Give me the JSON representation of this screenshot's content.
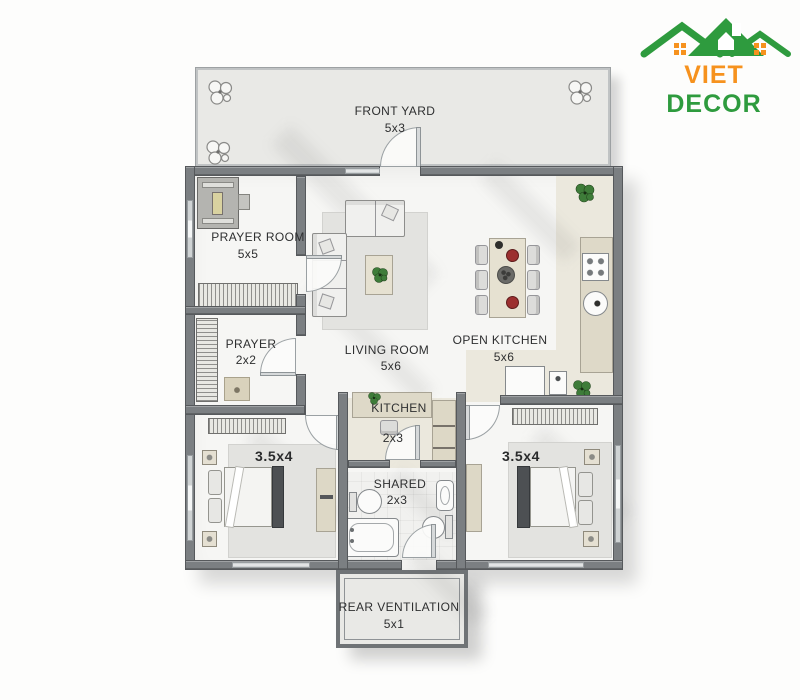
{
  "brand": {
    "word1": "VIET",
    "word2": "DECOR",
    "word1_color": "#F6921E",
    "word2_color": "#2E9B3E"
  },
  "rooms": {
    "front_yard": {
      "label": "FRONT YARD",
      "size": "5x3"
    },
    "prayer_room": {
      "label": "PRAYER ROOM",
      "size": "5x5"
    },
    "prayer": {
      "label": "PRAYER",
      "size": "2x2"
    },
    "living_room": {
      "label": "LIVING ROOM",
      "size": "5x6"
    },
    "open_kitchen": {
      "label": "OPEN KITCHEN",
      "size": "5x6"
    },
    "kitchen": {
      "label": "KITCHEN",
      "size": "2x3"
    },
    "bedroom_left": {
      "size": "3.5x4"
    },
    "shared": {
      "label": "SHARED",
      "size": "2x3"
    },
    "bedroom_right": {
      "size": "3.5x4"
    },
    "rear_ventilation": {
      "label": "REAR VENTILATION",
      "size": "5x1"
    }
  },
  "colors": {
    "wall": "#7B7F82",
    "floor": "#F6F6F4",
    "yard": "#E9E9E6",
    "counter_beige": "#DDD8C6",
    "accent_green": "#2E9B3E",
    "accent_orange": "#F6921E"
  }
}
